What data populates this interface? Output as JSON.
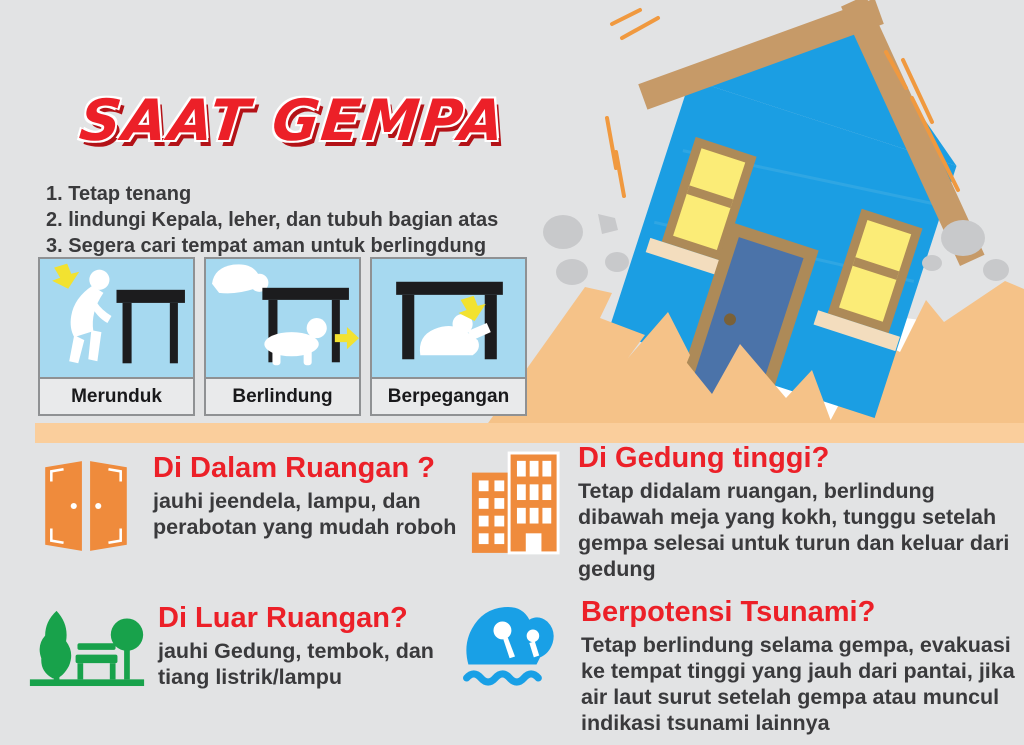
{
  "title": "SAAT GEMPA",
  "instructions": [
    "1. Tetap tenang",
    "2. lindungi Kepala, leher, dan tubuh bagian atas",
    "3. Segera cari tempat aman untuk berlingdung sementara"
  ],
  "steps": [
    {
      "label": "Merunduk"
    },
    {
      "label": "Berlindung"
    },
    {
      "label": "Berpegangan"
    }
  ],
  "sections": [
    {
      "icon": "door-icon",
      "heading": "Di Dalam Ruangan ?",
      "body": "jauhi jeendela, lampu, dan perabotan yang mudah roboh"
    },
    {
      "icon": "building-icon",
      "heading": "Di Gedung tinggi?",
      "body": "Tetap didalam ruangan, berlindung dibawah meja yang kokh, tunggu setelah gempa selesai untuk turun dan keluar dari gedung"
    },
    {
      "icon": "park-icon",
      "heading": "Di Luar Ruangan?",
      "body": "jauhi Gedung, tembok, dan tiang listrik/lampu"
    },
    {
      "icon": "wave-icon",
      "heading": "Berpotensi Tsunami?",
      "body": "Tetap berlindung selama gempa, evakuasi ke tempat tinggi yang jauh dari pantai, jika air laut surut setelah gempa atau muncul indikasi tsunami lainnya"
    }
  ],
  "colors": {
    "background": "#e2e3e4",
    "accent-red": "#ec2028",
    "accent-red-shadow": "#b31217",
    "text-dark": "#3a3a3c",
    "panel-blue": "#a6d9f0",
    "panel-label-bg": "#e9eaeb",
    "panel-border": "#8f9193",
    "table-black": "#1c1c1e",
    "arrow-yellow": "#f2e230",
    "house-blue": "#1b9ee3",
    "roof-brown": "#c69a68",
    "door-blue": "#4b73a9",
    "frame-brown": "#ad8a58",
    "window-yellow": "#fbec77",
    "sill-cream": "#f3ddbe",
    "ground-tan": "#f5c288",
    "strip-tan": "#face9c",
    "rock-gray": "#c8c9cb",
    "shake-orange": "#f0993f",
    "icon-orange": "#ef8b3c",
    "icon-green": "#18a24b",
    "icon-blue": "#19a0e6"
  }
}
